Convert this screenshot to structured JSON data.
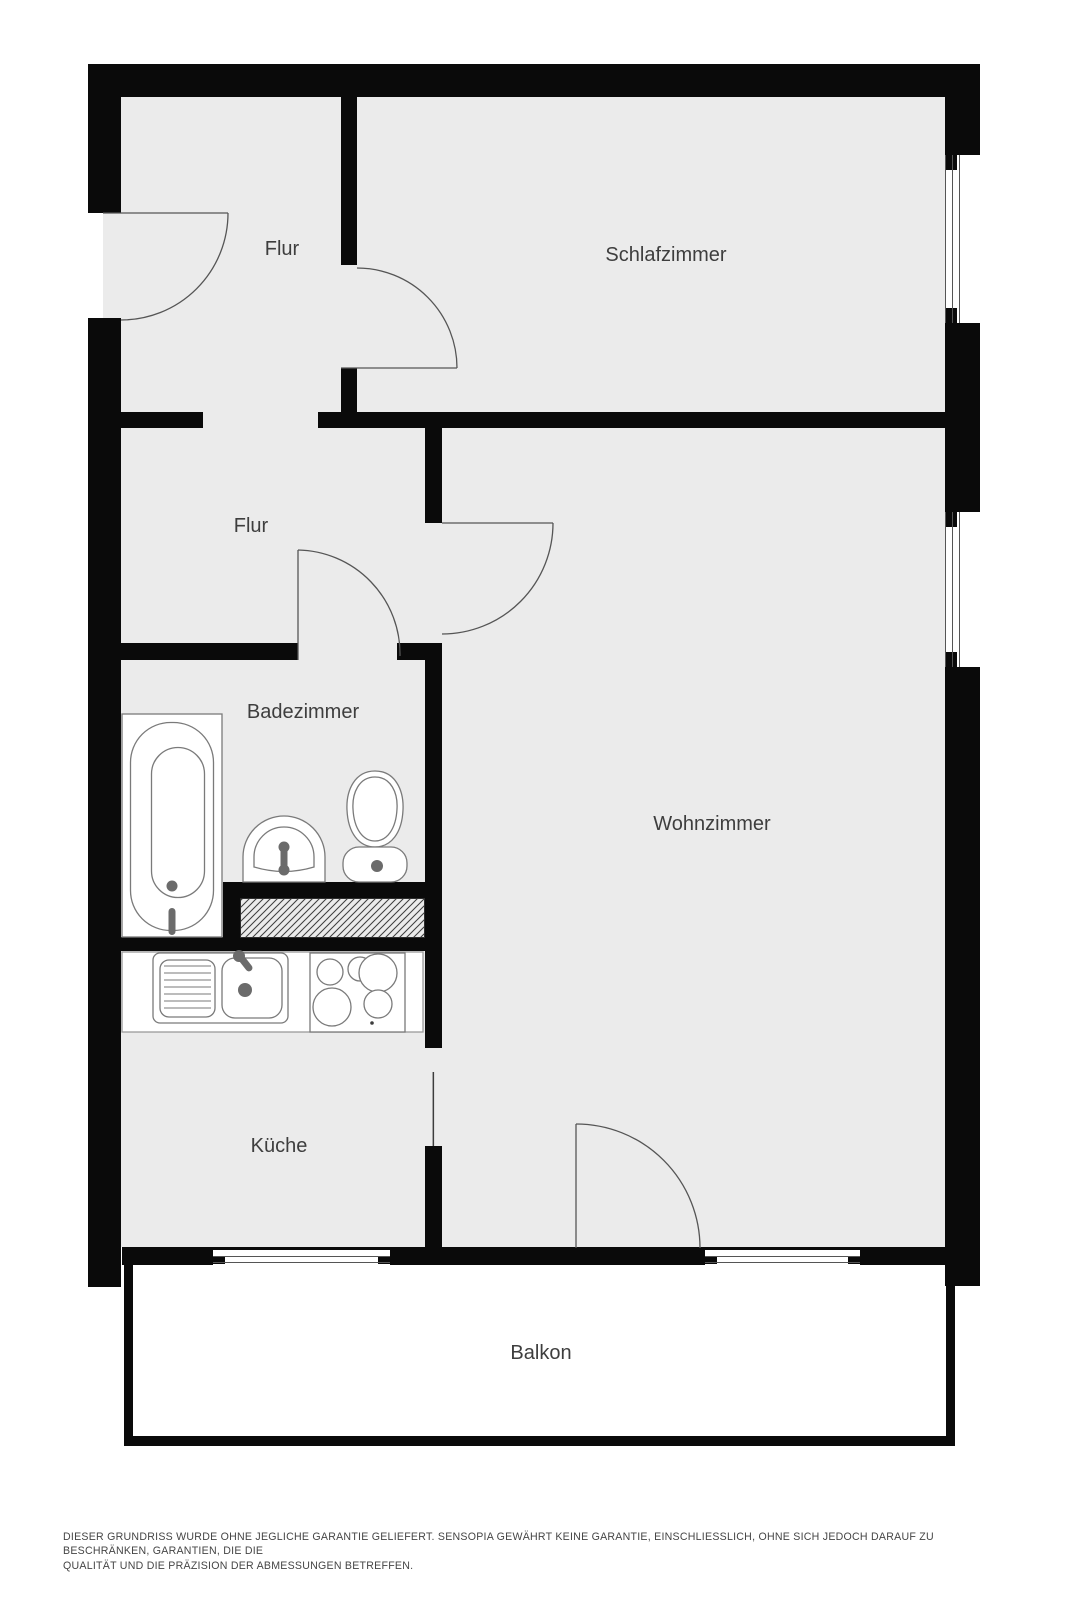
{
  "rooms": [
    {
      "id": "flur-entrance",
      "label": "Flur"
    },
    {
      "id": "schlafzimmer",
      "label": "Schlafzimmer"
    },
    {
      "id": "flur",
      "label": "Flur"
    },
    {
      "id": "badezimmer",
      "label": "Badezimmer"
    },
    {
      "id": "wohnzimmer",
      "label": "Wohnzimmer"
    },
    {
      "id": "kueche",
      "label": "Küche"
    },
    {
      "id": "balkon",
      "label": "Balkon"
    }
  ],
  "fixtures": [
    "bathtub-icon",
    "washbasin-icon",
    "toilet-icon",
    "kitchen-sink-icon",
    "stove-icon",
    "duct-hatch"
  ],
  "colors": {
    "background": "#ffffff",
    "wall": "#0a0a0a",
    "floor": "#ebebeb",
    "door_line": "#555555",
    "fixture_outline": "#7a7a7a",
    "label_text": "#3e3e3e",
    "disclaimer_text": "#454545"
  },
  "disclaimer": {
    "line1": "DIESER GRUNDRISS WURDE OHNE JEGLICHE GARANTIE GELIEFERT. SENSOPIA GEWÄHRT KEINE GARANTIE, EINSCHLIESSLICH, OHNE SICH JEDOCH DARAUF ZU BESCHRÄNKEN, GARANTIEN, DIE DIE",
    "line2": "QUALITÄT UND DIE PRÄZISION DER ABMESSUNGEN BETREFFEN."
  }
}
